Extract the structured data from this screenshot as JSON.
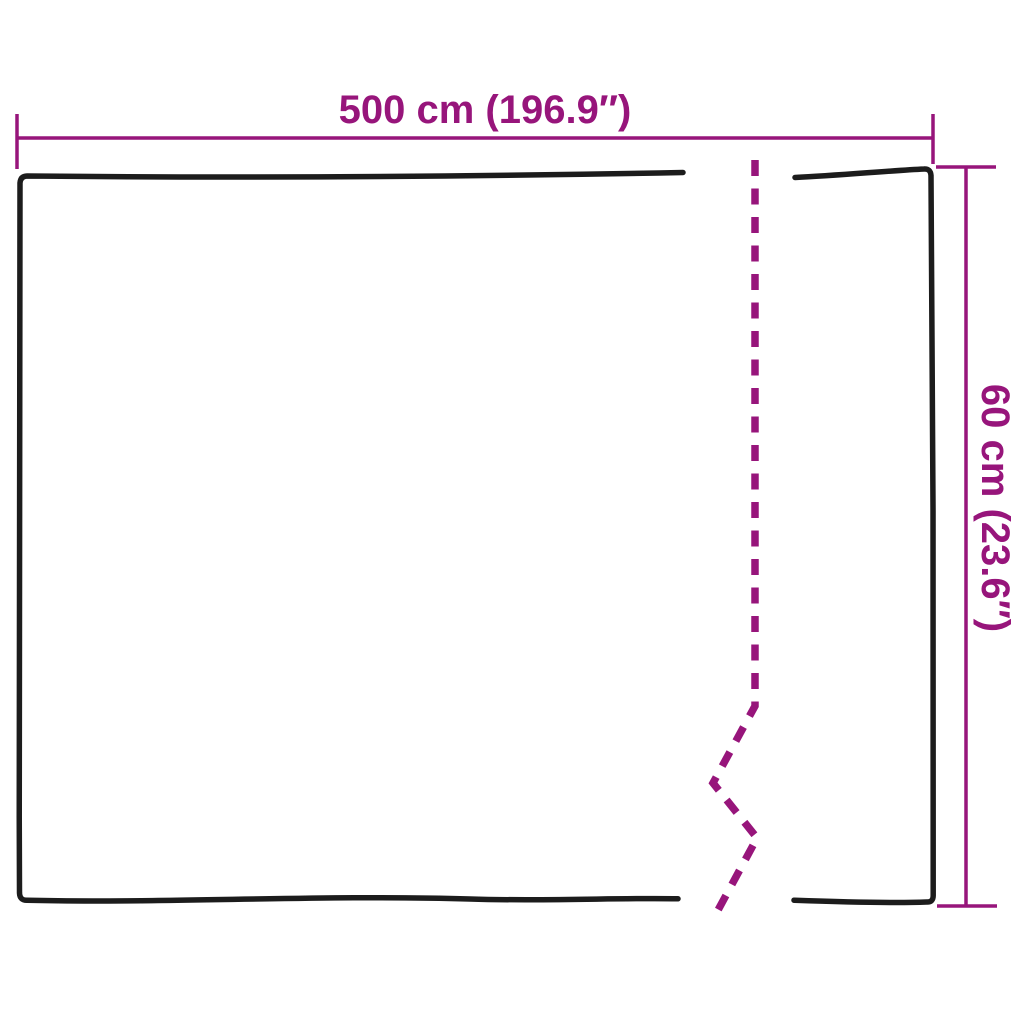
{
  "diagram": {
    "width_dimension": {
      "label": "500 cm (196.9″)",
      "value_cm": 500,
      "value_inches": 196.9
    },
    "height_dimension": {
      "label": "60 cm (23.6″)",
      "value_cm": 60,
      "value_inches": 23.6
    }
  },
  "colors": {
    "accent": "#97157B",
    "outline": "#1C1C1C",
    "background": "#FFFFFF"
  }
}
